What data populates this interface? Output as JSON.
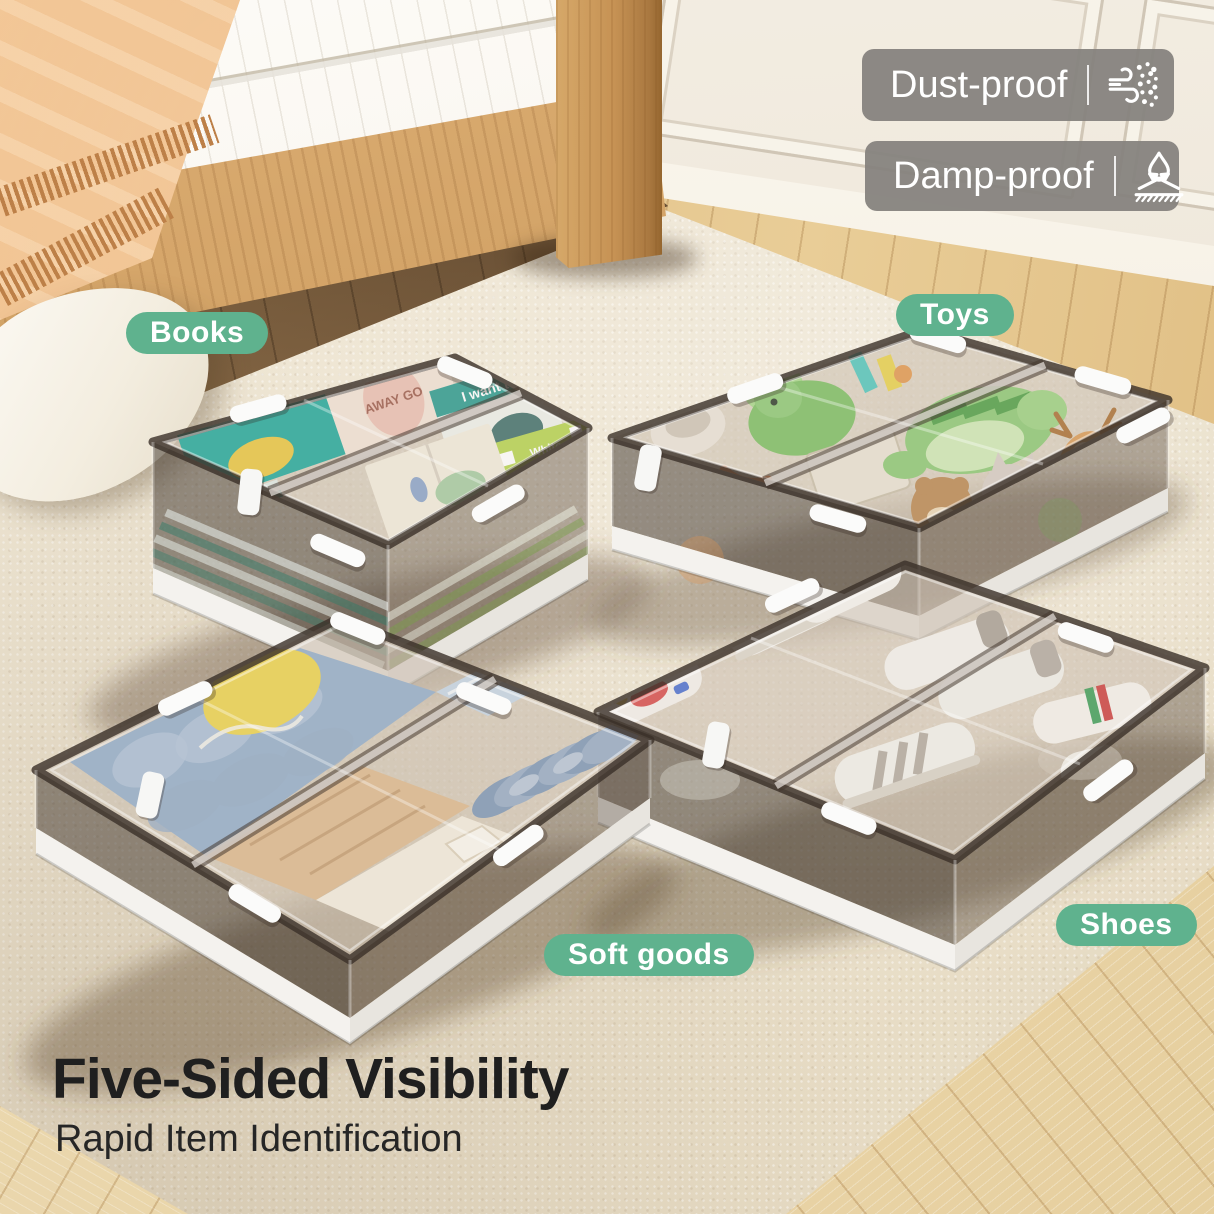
{
  "caption": {
    "headline": "Five-Sided Visibility",
    "subheadline": "Rapid Item Identification"
  },
  "feature_badges": {
    "dust": {
      "label": "Dust-proof",
      "icon": "wind-dust-icon"
    },
    "damp": {
      "label": "Damp-proof",
      "icon": "water-repel-icon"
    }
  },
  "product_labels": {
    "books": "Books",
    "toys": "Toys",
    "soft_goods": "Soft goods",
    "shoes": "Shoes"
  },
  "photo_text": {
    "book_cover_1": "AWAY GO",
    "book_cover_2": "I want to",
    "book_cover_3": "White"
  },
  "colors": {
    "label_green": "#5fb28e",
    "badge_gray": "rgba(134,131,126,0.95)",
    "headline_text": "#1f1f1f"
  }
}
